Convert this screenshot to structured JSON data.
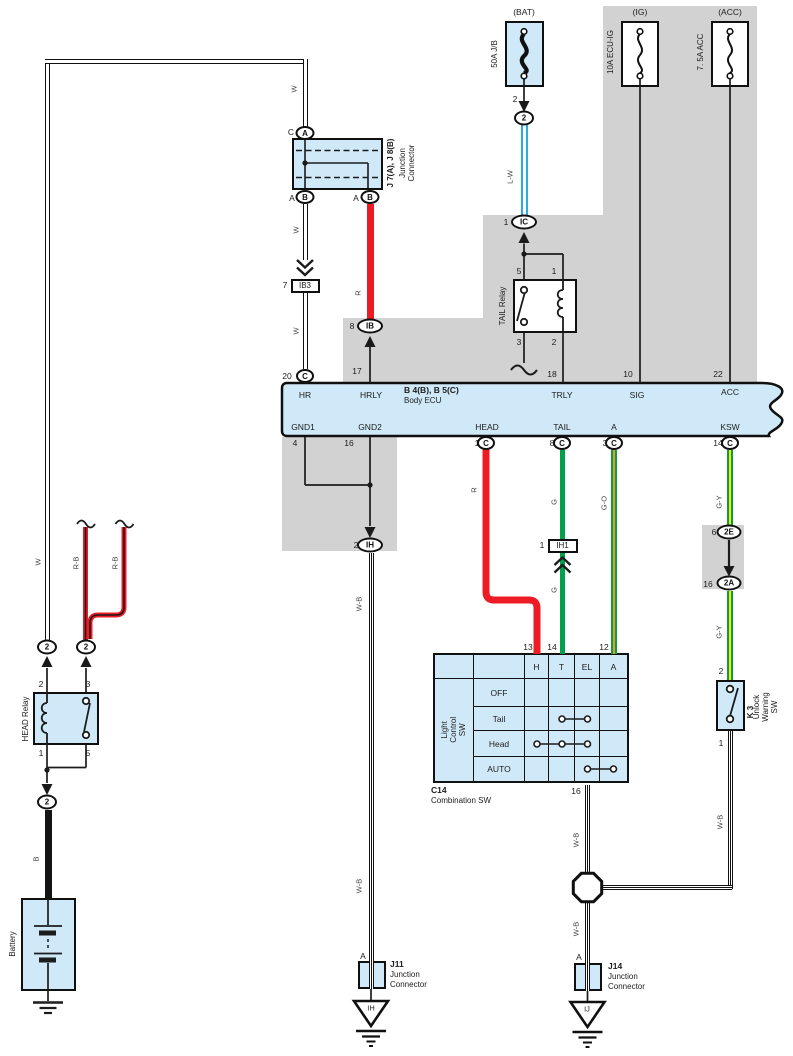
{
  "fuses": {
    "bat": {
      "header": "(BAT)",
      "name": "50A J/B",
      "pin": "2"
    },
    "ig": {
      "header": "(IG)",
      "name": "10A ECU-IG"
    },
    "acc": {
      "header": "(ACC)",
      "name": "7. 5A ACC"
    }
  },
  "wires": {
    "w": "W",
    "wb": "W-B",
    "rb": "R-B",
    "lw": "L-W",
    "r": "R",
    "g": "G",
    "go": "G-O",
    "gy": "G-Y",
    "b": "B"
  },
  "ovals": {
    "a": "A",
    "b": "B",
    "c": "C",
    "two": "2",
    "ic": "IC",
    "ib": "IB",
    "ih": "IH",
    "e2": "2E",
    "a2": "2A"
  },
  "junction_top": {
    "name": "J 7(A), J 8(B)",
    "desc": "Junction\nConnector",
    "pin_top": "C",
    "pin_bl": "A",
    "pin_br": "A"
  },
  "ib3": {
    "num": "7",
    "label": "IB3"
  },
  "ih1": {
    "num": "1",
    "label": "IH1"
  },
  "nums": {
    "bat_pin": "2",
    "ic": "1",
    "ib": "8",
    "hr": "20",
    "hrly": "17",
    "trly": "18",
    "sig": "10",
    "acc": "22",
    "gnd1": "4",
    "gnd2": "16",
    "head": "1",
    "tail": "8",
    "a": "3",
    "ksw": "14",
    "ih": "2",
    "e2": "6",
    "a2": "16",
    "k2": "2",
    "k1": "1",
    "h2": "2",
    "h3": "3",
    "h1": "1",
    "h5": "5",
    "t5": "5",
    "t1": "1",
    "t3": "3",
    "t2": "2",
    "c13": "13",
    "c14": "14",
    "c12": "12",
    "c16": "16",
    "j11_pin": "A",
    "j14_pin": "A"
  },
  "tail_relay": {
    "name": "TAIL Relay"
  },
  "head_relay": {
    "name": "HEAD Relay"
  },
  "battery": {
    "name": "Battery"
  },
  "ecu": {
    "title": "B 4(B), B 5(C)",
    "subtitle": "Body ECU",
    "top_labels": [
      "HR",
      "HRLY",
      "TRLY",
      "SIG",
      "ACC"
    ],
    "bottom_labels": [
      "GND1",
      "GND2",
      "HEAD",
      "TAIL",
      "A",
      "KSW"
    ]
  },
  "comb_sw": {
    "id": "C14",
    "name": "Combination SW",
    "side": "Light\nControl SW",
    "cols": [
      "H",
      "T",
      "EL",
      "A"
    ],
    "rows": [
      "OFF",
      "Tail",
      "Head",
      "AUTO"
    ]
  },
  "unlock_sw": {
    "id": "K 3",
    "name": "Unlock\nWarning SW"
  },
  "j11": {
    "id": "J11",
    "line1": "Junction",
    "line2": "Connector",
    "tri": "IH"
  },
  "j14": {
    "id": "J14",
    "line1": "Junction",
    "line2": "Connector",
    "tri": "IJ"
  }
}
